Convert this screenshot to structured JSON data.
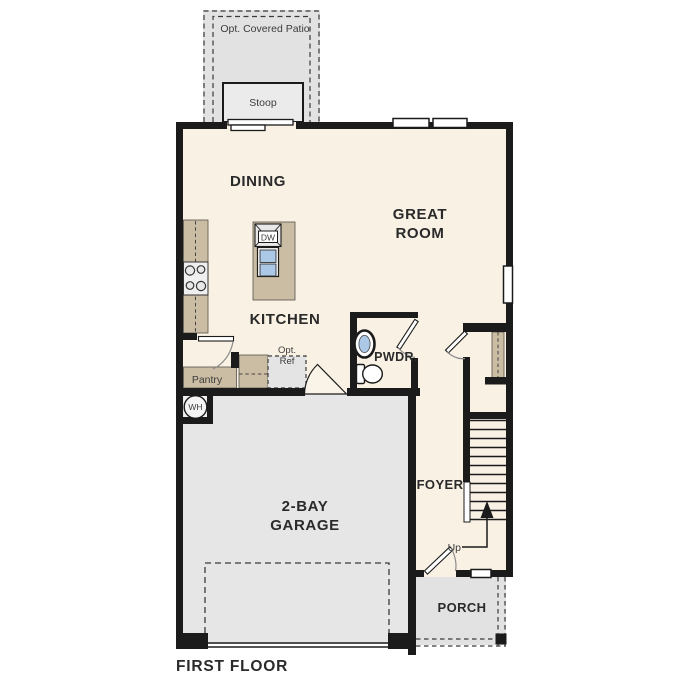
{
  "plan": {
    "title": "FIRST FLOOR",
    "rooms": {
      "dining": "DINING",
      "great_room_l1": "GREAT",
      "great_room_l2": "ROOM",
      "kitchen": "KITCHEN",
      "powder": "PWDR.",
      "foyer": "FOYER",
      "garage_l1": "2-BAY",
      "garage_l2": "GARAGE",
      "porch": "PORCH"
    },
    "features": {
      "patio": "Opt. Covered Patio",
      "stoop": "Stoop",
      "pantry": "Pantry",
      "opt_ref_l1": "Opt.",
      "opt_ref_l2": "Ref",
      "dishwasher": "DW",
      "water_heater": "WH",
      "stairs_up": "Up"
    },
    "colors": {
      "wall": "#1b1b1b",
      "interior": "#f8f1e4",
      "garage": "#e6e6e6",
      "outdoor": "#e2e2e2",
      "stoop_fill": "#ebebeb",
      "counter": "#cbbda3",
      "fixture_blue": "#abc8e6"
    }
  }
}
